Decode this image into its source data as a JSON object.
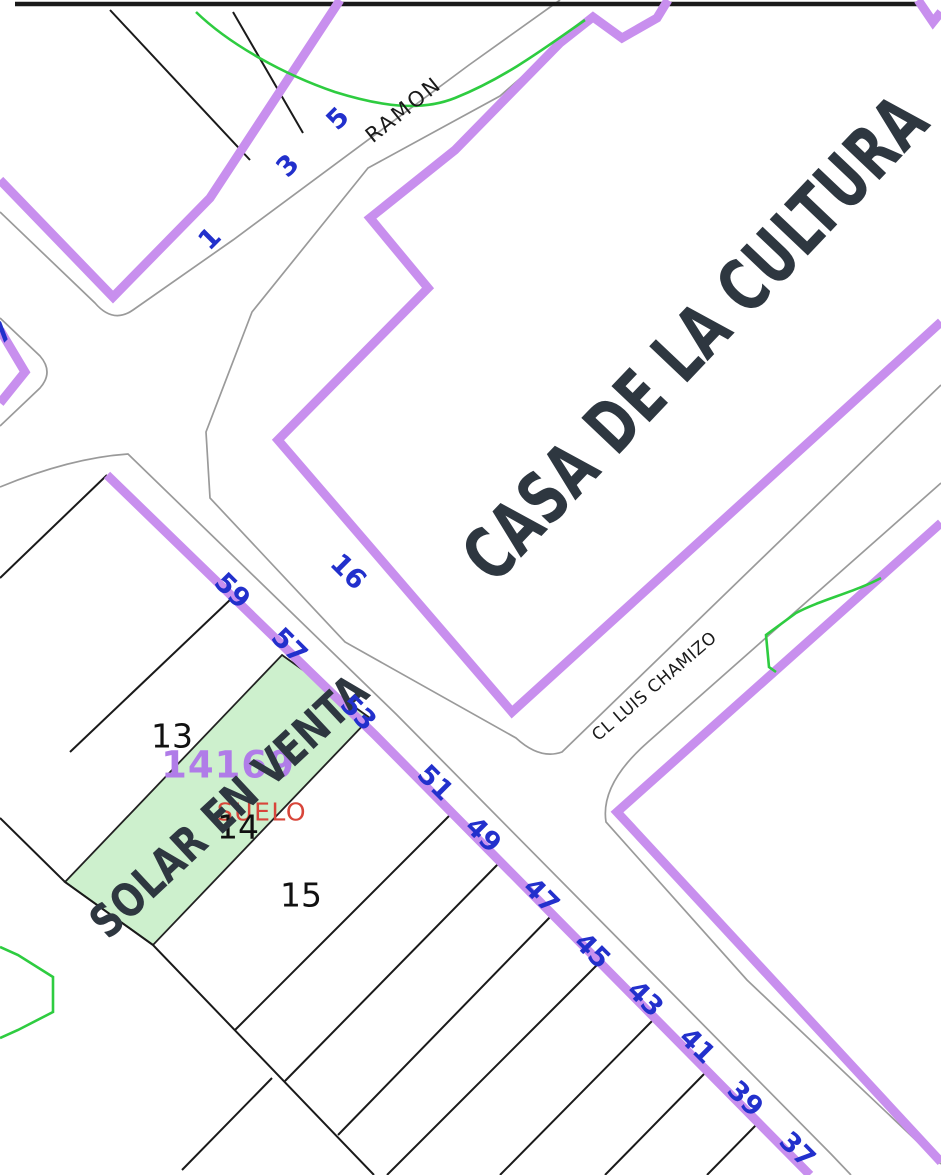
{
  "map": {
    "type": "cadastral-parcel-map",
    "highlighted_parcel": {
      "label": "SOLAR EN VENTA",
      "status_text": "SUELO",
      "parcel_number": "14",
      "block_number": "14169",
      "fill_color": "#cdf0cd"
    },
    "streets": [
      {
        "name": "RAMON",
        "house_numbers": [
          "1",
          "3",
          "5"
        ]
      },
      {
        "name": "CL LUIS CHAMIZO",
        "house_numbers": []
      },
      {
        "name": "",
        "house_numbers": [
          "59",
          "57",
          "53",
          "51",
          "49",
          "47",
          "45",
          "43",
          "41",
          "39",
          "37",
          "16",
          "7"
        ]
      }
    ],
    "building_label": "CASA DE LA CULTURA",
    "parcel_numbers": [
      "13",
      "14",
      "15"
    ],
    "colors": {
      "block_boundary": "#c88fee",
      "house_number_blue": "#2230cc",
      "street_edge_gray": "#9a9a9a",
      "parcel_line_black": "#1a1a1a",
      "overlay_green": "#2ecc40",
      "title_dark": "#2e3740",
      "suelo_red": "#d8453a",
      "block_number_purple": "#b07ce8"
    }
  },
  "labels": [
    {
      "name": "building-label-casa-de-la-cultura",
      "text": "CASA DE LA CULTURA",
      "x": 695,
      "y": 338,
      "rot": -46.5,
      "cls": "big-title"
    },
    {
      "name": "block-number-label",
      "text": "14169",
      "x": 228,
      "y": 765,
      "rot": 0,
      "cls": "block-num"
    },
    {
      "name": "suelo-label",
      "text": "SUELO",
      "x": 262,
      "y": 812,
      "rot": 0,
      "cls": "suelo"
    },
    {
      "name": "parcel-number-14",
      "text": "14",
      "x": 238,
      "y": 827,
      "rot": 0,
      "cls": "parcel-num"
    },
    {
      "name": "solar-en-venta-label",
      "text": "SOLAR EN VENTA",
      "x": 229,
      "y": 806,
      "rot": -43,
      "cls": "solar-title"
    },
    {
      "name": "street-name-ramon",
      "text": "RAMON",
      "x": 404,
      "y": 110,
      "rot": -39,
      "cls": "street-name"
    },
    {
      "name": "street-name-cl-luis-chamizo",
      "text": "CL LUIS CHAMIZO",
      "x": 655,
      "y": 687,
      "rot": -40.5,
      "cls": "street-name-sm"
    },
    {
      "name": "parcel-number-13",
      "text": "13",
      "x": 172,
      "y": 736,
      "rot": 0,
      "cls": "parcel-num"
    },
    {
      "name": "parcel-number-15",
      "text": "15",
      "x": 301,
      "y": 895,
      "rot": 0,
      "cls": "parcel-num"
    },
    {
      "name": "house-number-1",
      "text": "1",
      "x": 210,
      "y": 239,
      "rot": -45,
      "cls": "num"
    },
    {
      "name": "house-number-3",
      "text": "3",
      "x": 288,
      "y": 166,
      "rot": -45,
      "cls": "num"
    },
    {
      "name": "house-number-5",
      "text": "5",
      "x": 338,
      "y": 119,
      "rot": -45,
      "cls": "num"
    },
    {
      "name": "house-number-7-partial",
      "text": "7",
      "x": 2,
      "y": 333,
      "rot": -45,
      "cls": "num"
    },
    {
      "name": "house-number-16",
      "text": "16",
      "x": 348,
      "y": 572,
      "rot": 45,
      "cls": "num"
    },
    {
      "name": "house-number-59",
      "text": "59",
      "x": 232,
      "y": 591,
      "rot": 45,
      "cls": "num"
    },
    {
      "name": "house-number-57",
      "text": "57",
      "x": 289,
      "y": 646,
      "rot": 45,
      "cls": "num"
    },
    {
      "name": "house-number-53",
      "text": "53",
      "x": 358,
      "y": 713,
      "rot": 45,
      "cls": "num"
    },
    {
      "name": "house-number-51",
      "text": "51",
      "x": 435,
      "y": 783,
      "rot": 45,
      "cls": "num"
    },
    {
      "name": "house-number-49",
      "text": "49",
      "x": 483,
      "y": 835,
      "rot": 45,
      "cls": "num"
    },
    {
      "name": "house-number-47",
      "text": "47",
      "x": 541,
      "y": 896,
      "rot": 45,
      "cls": "num"
    },
    {
      "name": "house-number-45",
      "text": "45",
      "x": 592,
      "y": 951,
      "rot": 45,
      "cls": "num"
    },
    {
      "name": "house-number-43",
      "text": "43",
      "x": 645,
      "y": 999,
      "rot": 45,
      "cls": "num"
    },
    {
      "name": "house-number-41",
      "text": "41",
      "x": 697,
      "y": 1046,
      "rot": 45,
      "cls": "num"
    },
    {
      "name": "house-number-39",
      "text": "39",
      "x": 745,
      "y": 1099,
      "rot": 45,
      "cls": "num"
    },
    {
      "name": "house-number-37",
      "text": "37",
      "x": 797,
      "y": 1150,
      "rot": 45,
      "cls": "num"
    }
  ]
}
